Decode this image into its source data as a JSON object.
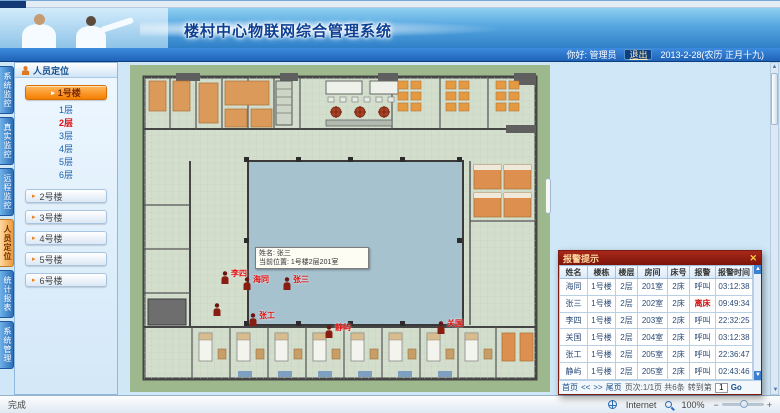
{
  "header": {
    "title": "楼村中心物联网综合管理系统",
    "greeting": "你好: 管理员",
    "logout": "退出",
    "date": "2013-2-28(农历 正月十九)"
  },
  "vtabs": {
    "items": [
      {
        "label": "系统监控",
        "active": false
      },
      {
        "label": "真实监控",
        "active": false
      },
      {
        "label": "远程监控",
        "active": false
      },
      {
        "label": "人员定位",
        "active": true
      },
      {
        "label": "统计报表",
        "active": false
      },
      {
        "label": "系统管理",
        "active": false
      }
    ]
  },
  "sidebar": {
    "header": "人员定位",
    "selected_building": "1号楼",
    "floors": [
      {
        "label": "1层",
        "alert": false
      },
      {
        "label": "2层",
        "alert": true
      },
      {
        "label": "3层",
        "alert": false
      },
      {
        "label": "4层",
        "alert": false
      },
      {
        "label": "5层",
        "alert": false
      },
      {
        "label": "6层",
        "alert": false
      }
    ],
    "buildings": [
      "2号楼",
      "3号楼",
      "4号楼",
      "5号楼",
      "6号楼"
    ]
  },
  "floorplan": {
    "tooltip": {
      "line1": "姓名: 张三",
      "line2": "当前位置: 1号楼2层201室"
    },
    "markers": [
      {
        "x": 90,
        "y": 206,
        "label": "李四"
      },
      {
        "x": 112,
        "y": 212,
        "label": "海同"
      },
      {
        "x": 152,
        "y": 212,
        "label": "张三"
      },
      {
        "x": 82,
        "y": 238,
        "label": ""
      },
      {
        "x": 118,
        "y": 248,
        "label": "张工"
      },
      {
        "x": 194,
        "y": 260,
        "label": "静屿"
      },
      {
        "x": 306,
        "y": 256,
        "label": "关国"
      }
    ]
  },
  "popup": {
    "title": "报警提示",
    "close": "✕",
    "columns": [
      "姓名",
      "楼栋",
      "楼层",
      "房间",
      "床号",
      "报警",
      "报警时间"
    ],
    "rows": [
      [
        "海同",
        "1号楼",
        "2层",
        "201室",
        "2床",
        "呼叫",
        "03:12:38"
      ],
      [
        "张三",
        "1号楼",
        "2层",
        "202室",
        "2床",
        "离床",
        "09:49:34"
      ],
      [
        "李四",
        "1号楼",
        "2层",
        "203室",
        "2床",
        "呼叫",
        "22:32:25"
      ],
      [
        "关国",
        "1号楼",
        "2层",
        "204室",
        "2床",
        "呼叫",
        "03:12:38"
      ],
      [
        "张工",
        "1号楼",
        "2层",
        "205室",
        "2床",
        "呼叫",
        "22:36:47"
      ],
      [
        "静屿",
        "1号楼",
        "2层",
        "205室",
        "2床",
        "呼叫",
        "02:43:46"
      ]
    ],
    "alert_value": "离床",
    "pager": {
      "first": "首页",
      "prev": "<<",
      "next": ">>",
      "last": "尾页",
      "info": "页次:1/1页 共6条",
      "goto_label": "转到第",
      "page": "1",
      "go_label": "Go"
    }
  },
  "statusbar": {
    "left": "完成",
    "network": "Internet",
    "zoom": "100%"
  }
}
